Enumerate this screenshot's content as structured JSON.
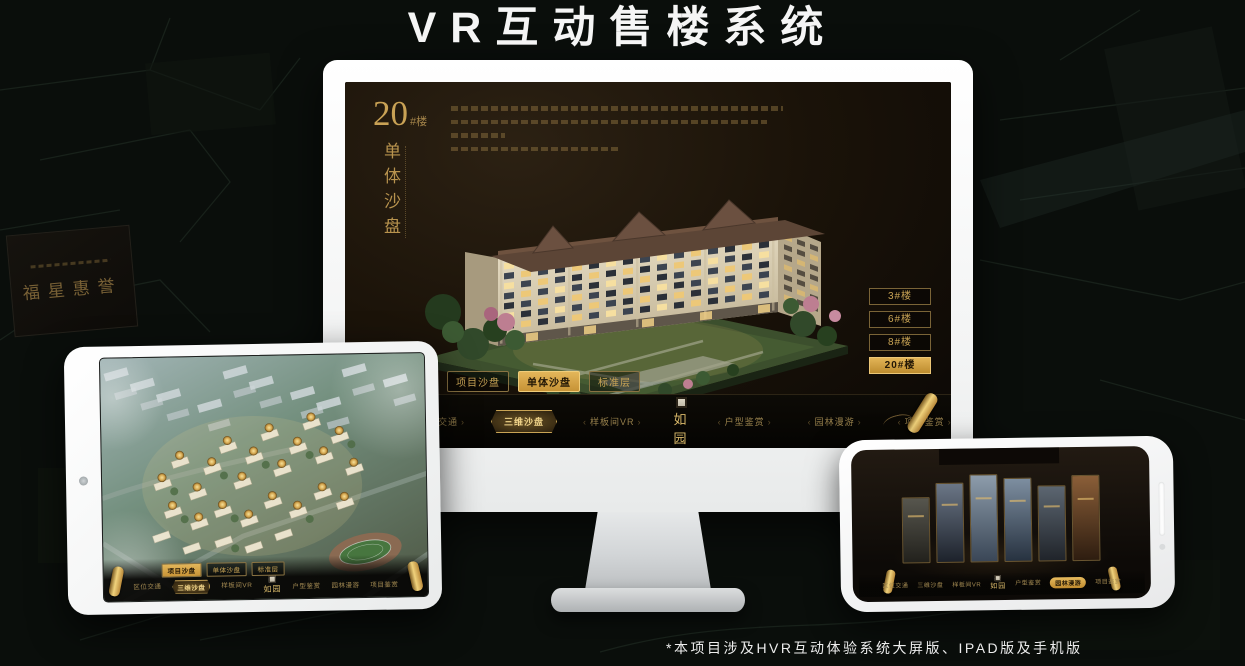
{
  "page": {
    "title": "VR互动售楼系统",
    "footnote": "*本项目涉及HVR互动体验系统大屏版、IPAD版及手机版"
  },
  "background": {
    "plaque_text": "福星惠誉"
  },
  "colors": {
    "gold": "#c9a455",
    "gold_bright": "#e3b65a",
    "screen_bg": "#1b1309",
    "page_bg": "#0a0e0b"
  },
  "monitor": {
    "block": {
      "number": "20",
      "unit": "#楼",
      "subtitle": "单体沙盘"
    },
    "floor_buttons": [
      {
        "label": "3#楼"
      },
      {
        "label": "6#楼"
      },
      {
        "label": "8#楼"
      },
      {
        "label": "20#楼",
        "active": true
      }
    ],
    "tabs": [
      {
        "label": "项目沙盘"
      },
      {
        "label": "单体沙盘",
        "active": true
      },
      {
        "label": "标准层"
      }
    ],
    "menu_left": [
      {
        "label": "区位交通"
      },
      {
        "label": "三维沙盘",
        "active": true
      },
      {
        "label": "样板间VR"
      }
    ],
    "logo": "如园",
    "menu_right": [
      {
        "label": "户型鉴赏"
      },
      {
        "label": "园林漫游"
      },
      {
        "label": "项目鉴赏"
      }
    ]
  },
  "tablet": {
    "tabs": [
      {
        "label": "项目沙盘",
        "active": true
      },
      {
        "label": "单体沙盘"
      },
      {
        "label": "标准层"
      }
    ],
    "menu_left": [
      {
        "label": "区位交通"
      },
      {
        "label": "三维沙盘",
        "active": true
      },
      {
        "label": "样板间VR"
      }
    ],
    "logo": "如园",
    "menu_right": [
      {
        "label": "户型鉴赏"
      },
      {
        "label": "园林漫游"
      },
      {
        "label": "项目鉴赏"
      }
    ]
  },
  "phone": {
    "menu_left": [
      {
        "label": "区位交通"
      },
      {
        "label": "三维沙盘"
      },
      {
        "label": "样板间VR"
      }
    ],
    "logo": "如园",
    "menu_right": [
      {
        "label": "户型鉴赏"
      },
      {
        "label": "园林漫游",
        "active": true
      },
      {
        "label": "项目鉴赏"
      }
    ]
  }
}
